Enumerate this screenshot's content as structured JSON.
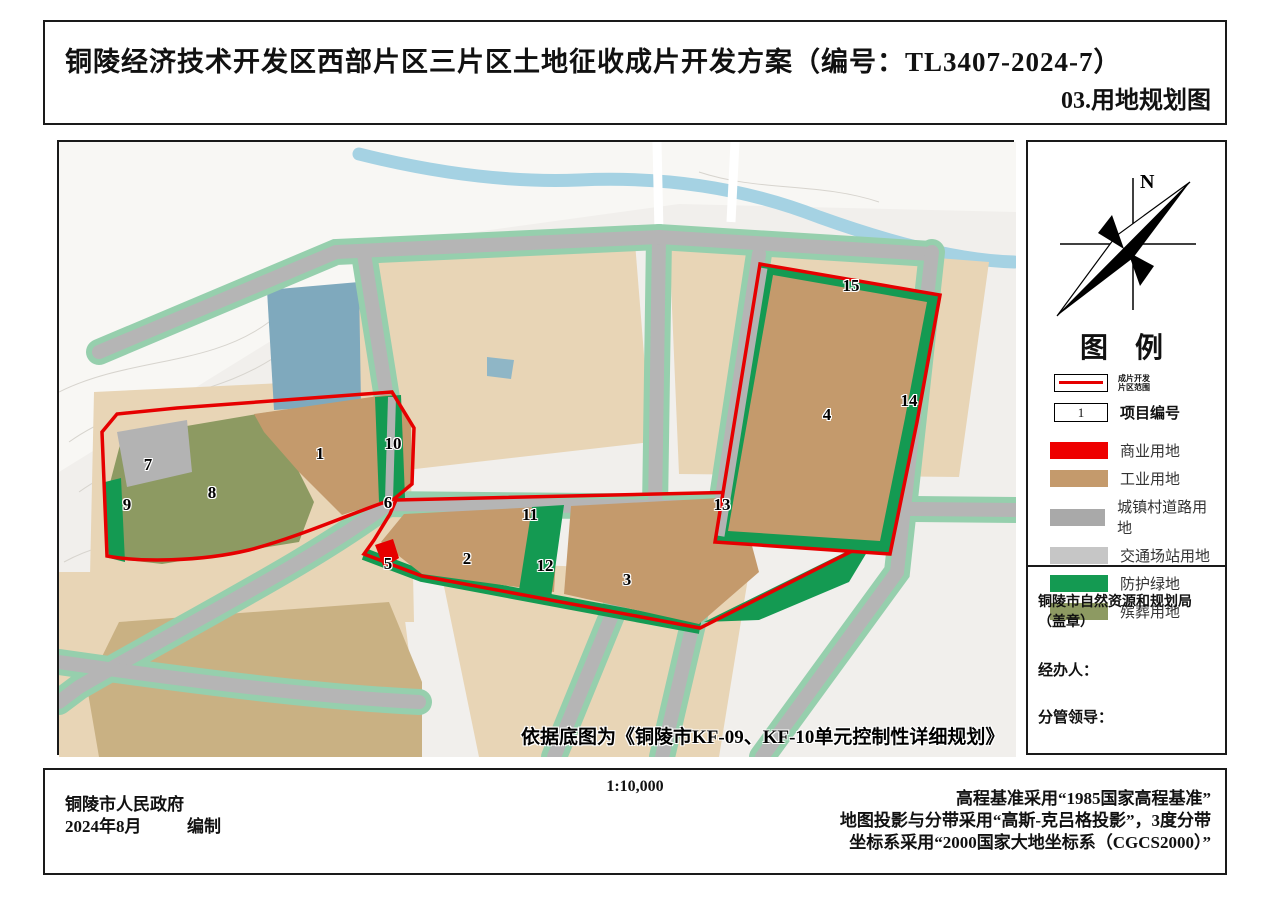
{
  "title": {
    "main": "铜陵经济技术开发区西部片区三片区土地征收成片开发方案（编号：TL3407-2024-7）",
    "sub": "03.用地规划图"
  },
  "map": {
    "note": "依据底图为《铜陵市KF-09、KF-10单元控制性详细规划》",
    "labels": [
      {
        "n": "1",
        "x": 318,
        "y": 452
      },
      {
        "n": "2",
        "x": 465,
        "y": 557
      },
      {
        "n": "3",
        "x": 625,
        "y": 578
      },
      {
        "n": "4",
        "x": 825,
        "y": 413
      },
      {
        "n": "5",
        "x": 386,
        "y": 562
      },
      {
        "n": "6",
        "x": 386,
        "y": 501
      },
      {
        "n": "7",
        "x": 146,
        "y": 463
      },
      {
        "n": "8",
        "x": 210,
        "y": 491
      },
      {
        "n": "9",
        "x": 125,
        "y": 503
      },
      {
        "n": "10",
        "x": 391,
        "y": 442
      },
      {
        "n": "11",
        "x": 528,
        "y": 513
      },
      {
        "n": "12",
        "x": 543,
        "y": 564
      },
      {
        "n": "13",
        "x": 720,
        "y": 503
      },
      {
        "n": "14",
        "x": 907,
        "y": 399
      },
      {
        "n": "15",
        "x": 849,
        "y": 284
      }
    ]
  },
  "sidebar": {
    "north_label": "N",
    "legend_title": "图 例",
    "boundary_item": {
      "line1": "成片开发",
      "line2": "片区范围"
    },
    "project_item": {
      "sample": "1",
      "label": "项目编号"
    },
    "items": [
      {
        "label": "商业用地",
        "color": "#ee0000"
      },
      {
        "label": "工业用地",
        "color": "#c49a6c"
      },
      {
        "label": "城镇村道路用地",
        "color": "#a9a9a9"
      },
      {
        "label": "交通场站用地",
        "color": "#c6c6c6"
      },
      {
        "label": "防护绿地",
        "color": "#149a52"
      },
      {
        "label": "殡葬用地",
        "color": "#8d9a62"
      }
    ],
    "stamp": {
      "agency": "铜陵市自然资源和规划局（盖章）",
      "handler": "经办人：",
      "leader": "分管领导："
    }
  },
  "footer": {
    "org": "铜陵市人民政府",
    "date": "2024年8月",
    "compiled": "编制",
    "scale": "1:10,000",
    "notes": [
      "高程基准采用“1985国家高程基准”",
      "地图投影与分带采用“高斯-克吕格投影”，3度分带",
      "坐标系采用“2000国家大地坐标系（CGCS2000）”"
    ]
  },
  "colors": {
    "boundary_red": "#e60000",
    "industrial_tan": "#c49a6c",
    "road_gray": "#a9a9a9",
    "transport_gray": "#c6c6c6",
    "green": "#149a52",
    "funeral_olive": "#8d9a62",
    "parcel_tan": "#e8d5b6",
    "parcel_khaki": "#c9b183",
    "parcel_teal": "#7fa9bd",
    "river_blue": "#a5d2e3"
  }
}
